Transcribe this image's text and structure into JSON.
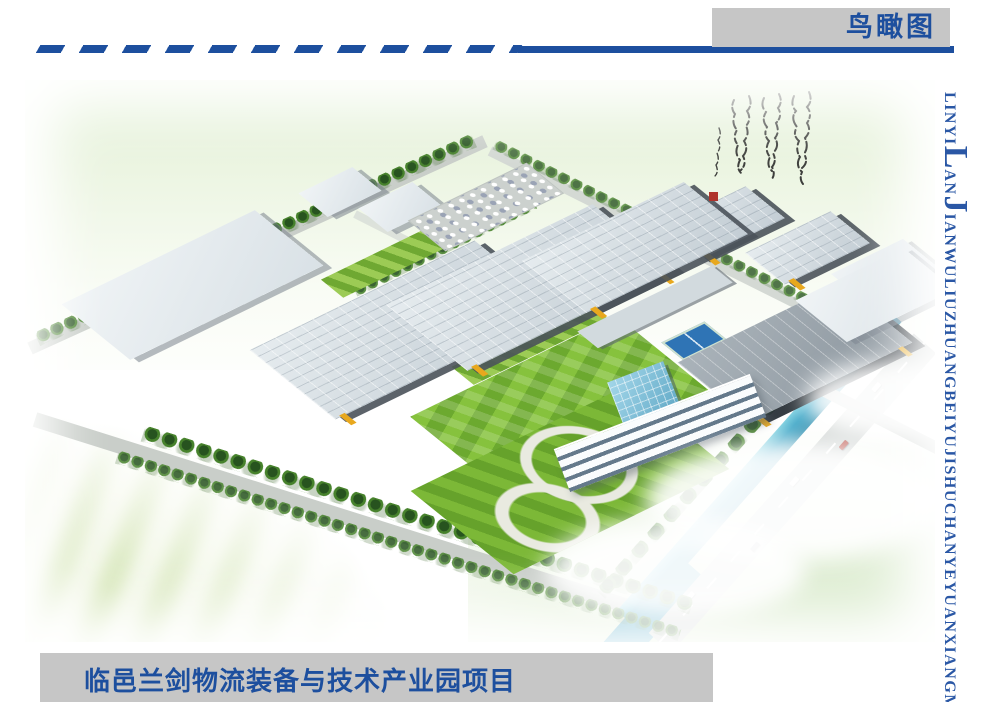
{
  "page": {
    "background": "#ffffff"
  },
  "header": {
    "title": "鸟瞰图",
    "accent_color": "#1d4f9e",
    "box_color": "#c6c6c6"
  },
  "side_label": {
    "color": "#2a57a5",
    "segments": [
      {
        "text": "LINYI",
        "size": "small"
      },
      {
        "text": "L",
        "size": "big"
      },
      {
        "text": "AN",
        "size": "small"
      },
      {
        "text": "J",
        "size": "big"
      },
      {
        "text": "IANWULIUZHUANGBEIYUJISHUCHANYEYUANXIANGMU",
        "size": "small"
      }
    ]
  },
  "footer": {
    "title": "临邑兰剑物流装备与技术产业园项目",
    "text_color": "#1d4f9e",
    "band_color": "#c6c6c6"
  },
  "scene": {
    "type": "aerial-rendering",
    "subject": "logistics-industrial-park-birds-eye-view",
    "palette": {
      "sky_green": "#e2f0d6",
      "roof_gray": "#d3dbe0",
      "wall_dark": "#4a525a",
      "accent_yellow": "#e8a81e",
      "lawn_green": "#86c23d",
      "tree_green": "#27531f",
      "canal_teal": "#46aac9",
      "road_gray": "#cfd4d2",
      "calligraphy_ink": "#1f1f1f",
      "seal_red": "#b0342c"
    }
  }
}
